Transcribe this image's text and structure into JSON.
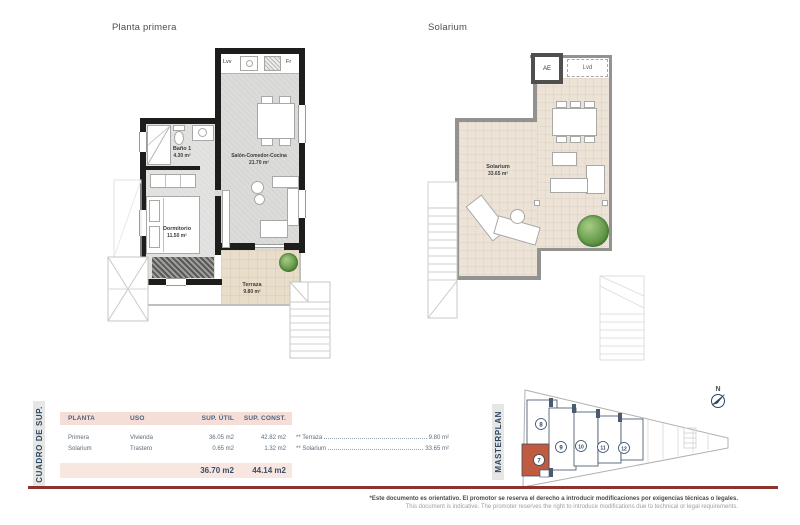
{
  "plans": {
    "first": {
      "title": "Planta primera",
      "kitchen": {
        "dishwasher": "Lvv",
        "fridge": "Fr"
      },
      "rooms": {
        "bath": {
          "name": "Baño 1",
          "area": "4.30 m²"
        },
        "living": {
          "name": "Salón-Comedor-Cocina",
          "area": "21.70 m²"
        },
        "bedroom": {
          "name": "Dormitorio",
          "area": "11.50 m²"
        },
        "terrace": {
          "name": "Terraza",
          "area": "9.80 m²"
        }
      }
    },
    "solarium": {
      "title": "Solarium",
      "labels": {
        "ac_unit": "AE",
        "laundry": "Lvd"
      },
      "rooms": {
        "solarium": {
          "name": "Solarium",
          "area": "33.65 m²"
        }
      }
    }
  },
  "surface_table": {
    "section_label": "CUADRO DE SUP.",
    "headers": {
      "planta": "PLANTA",
      "uso": "USO",
      "util": "SUP. ÚTIL",
      "const": "SUP. CONST."
    },
    "rows": [
      {
        "planta": "Primera",
        "uso": "Vivienda",
        "util": "36.05 m2",
        "const": "42.82 m2"
      },
      {
        "planta": "Solarium",
        "uso": "Trastero",
        "util": "0.65 m2",
        "const": "1.32 m2"
      }
    ],
    "totals": {
      "util": "36.70 m2",
      "const": "44.14 m2"
    },
    "annotations": [
      {
        "label": "** Terraza",
        "value": "9.80 m²"
      },
      {
        "label": "** Solarium",
        "value": "33.65 m²"
      }
    ]
  },
  "masterplan": {
    "section_label": "MASTERPLAN",
    "north_label": "N",
    "units": {
      "u7": "7",
      "u8": "8",
      "u9": "9",
      "u10": "10",
      "u11": "11",
      "u12": "12"
    },
    "highlighted_unit": "7",
    "highlight_color": "#bf5b3f"
  },
  "footer": {
    "disclaimer_es": "*Este documento es orientativo. El promotor se reserva el derecho a introducir modificaciones por exigencias técnicas o legales.",
    "disclaimer_en": "This document is indicative. The promoter reserves the right to introduce modifications due to technical or legal requirements."
  },
  "colors": {
    "accent_red": "#8c332d",
    "navy": "#2e4763",
    "header_pink": "#f6ded8",
    "terrace_beige": "#e8ddc9",
    "solarium_beige": "#ece3d6",
    "highlight_orange": "#bf5b3f"
  }
}
